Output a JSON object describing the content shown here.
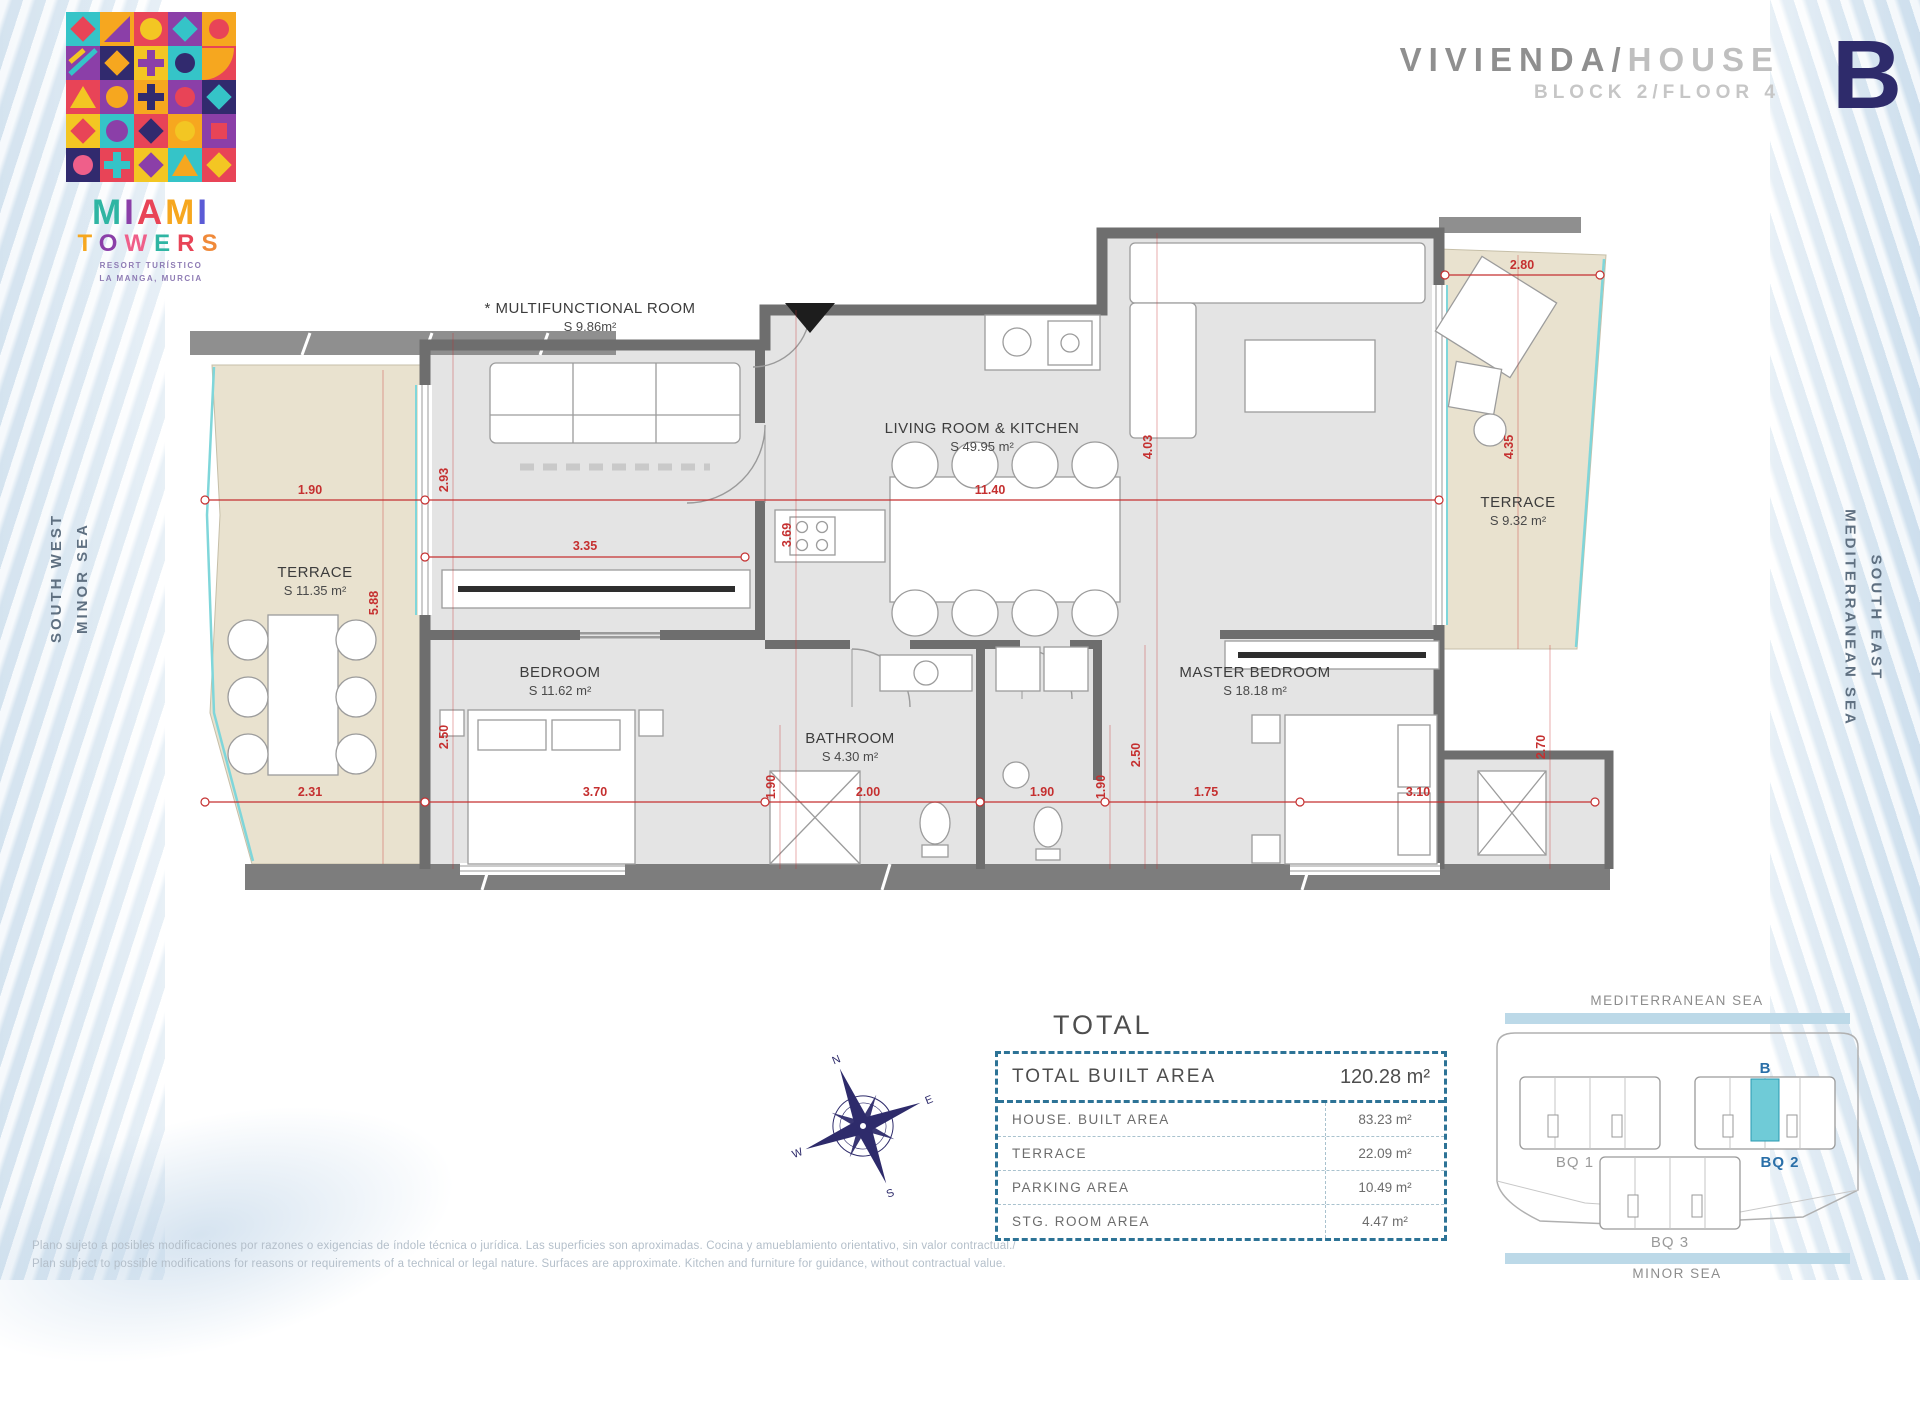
{
  "brand": {
    "miami": [
      "M",
      "I",
      "A",
      "M",
      "I"
    ],
    "towers": [
      "T",
      "O",
      "W",
      "E",
      "R",
      "S"
    ],
    "tagline1": "RESORT TURÍSTICO",
    "tagline2": "LA MANGA, MURCIA"
  },
  "header": {
    "title_primary": "VIVIENDA/",
    "title_secondary": "HOUSE",
    "subtitle": "BLOCK 2/FLOOR 4",
    "unit_letter": "B"
  },
  "side_labels": {
    "left_line1": "SOUTH WEST",
    "left_line2": "MINOR SEA",
    "right_line1": "SOUTH EAST",
    "right_line2": "MEDITERRANEAN SEA"
  },
  "plan": {
    "rooms": {
      "multifunctional": {
        "name": "* MULTIFUNCTIONAL ROOM",
        "area": "S 9.86m²"
      },
      "living": {
        "name": "LIVING ROOM & KITCHEN",
        "area": "S 49.95 m²"
      },
      "terrace_left": {
        "name": "TERRACE",
        "area": "S 11.35 m²"
      },
      "bedroom": {
        "name": "BEDROOM",
        "area": "S 11.62 m²"
      },
      "bathroom": {
        "name": "BATHROOM",
        "area": "S 4.30 m²"
      },
      "master": {
        "name": "MASTER BEDROOM",
        "area": "S 18.18 m²"
      },
      "terrace_right": {
        "name": "TERRACE",
        "area": "S 9.32 m²"
      }
    },
    "dims": {
      "a": "1.90",
      "b": "2.93",
      "c": "3.35",
      "d": "11.40",
      "e": "3.69",
      "f": "4.03",
      "g": "2.80",
      "h": "4.35",
      "i": "5.88",
      "j": "2.50",
      "k": "2.31",
      "l": "3.70",
      "m": "2.00",
      "n": "1.90",
      "o": "1.90",
      "p": "1.90",
      "q": "2.50",
      "r": "1.75",
      "s": "3.10",
      "t": "2.70"
    }
  },
  "total": {
    "title": "TOTAL",
    "rows": [
      {
        "label": "TOTAL BUILT AREA",
        "value": "120.28 m²"
      },
      {
        "label": "HOUSE. BUILT AREA",
        "value": "83.23 m²"
      },
      {
        "label": "TERRACE",
        "value": "22.09 m²"
      },
      {
        "label": "PARKING AREA",
        "value": "10.49 m²"
      },
      {
        "label": "STG. ROOM AREA",
        "value": "4.47 m²"
      }
    ]
  },
  "compass": {
    "n": "N",
    "e": "E",
    "s": "S",
    "w": "W"
  },
  "sitemap": {
    "top_label": "MEDITERRANEAN SEA",
    "bottom_label": "MINOR SEA",
    "unit_label": "B",
    "block1": "BQ 1",
    "block2": "BQ 2",
    "block3": "BQ 3"
  },
  "disclaimer": {
    "line1": "Plano sujeto a posibles modificaciones por razones o exigencias de índole técnica o jurídica. Las superficies son aproximadas. Cocina y amueblamiento orientativo, sin valor contractual./",
    "line2": "Plan subject to possible modifications for reasons or requirements of a technical or legal nature. Surfaces are approximate. Kitchen and furniture for guidance, without contractual value."
  },
  "colors": {
    "dimension_red": "#c53030",
    "wall_gray": "#6e6e6e",
    "terrace_tan": "#e9e2cf",
    "navy": "#2e2b6b",
    "table_border_blue": "#2d7396",
    "sitemap_highlight_cyan": "#6fcbd7",
    "sea_bar_blue": "#bcd9e8"
  }
}
